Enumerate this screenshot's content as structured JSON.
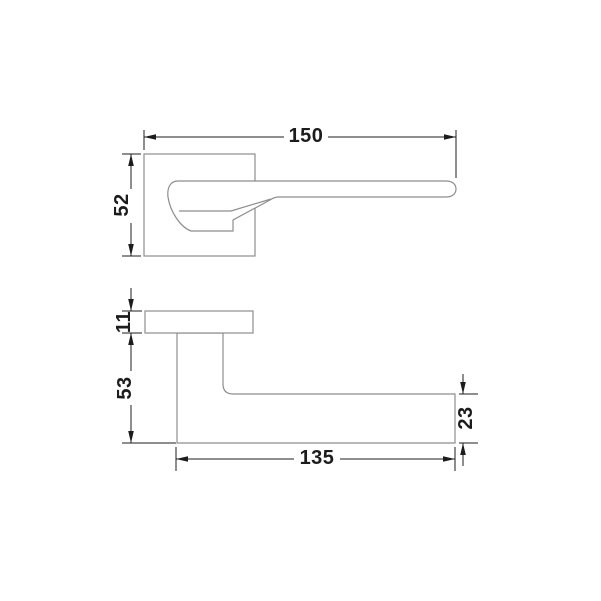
{
  "drawing_title": "door-lever-handle-technical-drawing",
  "colors": {
    "background": "#ffffff",
    "outline": "#8e8e8e",
    "dimension": "#1c1c1c"
  },
  "views": {
    "front": {
      "name": "front-view",
      "dims": {
        "overall_length": "150",
        "rosette_height": "52"
      }
    },
    "side": {
      "name": "side-view",
      "dims": {
        "rosette_thickness": "11",
        "drop_height": "53",
        "lever_length": "135",
        "lever_thickness": "23"
      }
    }
  }
}
